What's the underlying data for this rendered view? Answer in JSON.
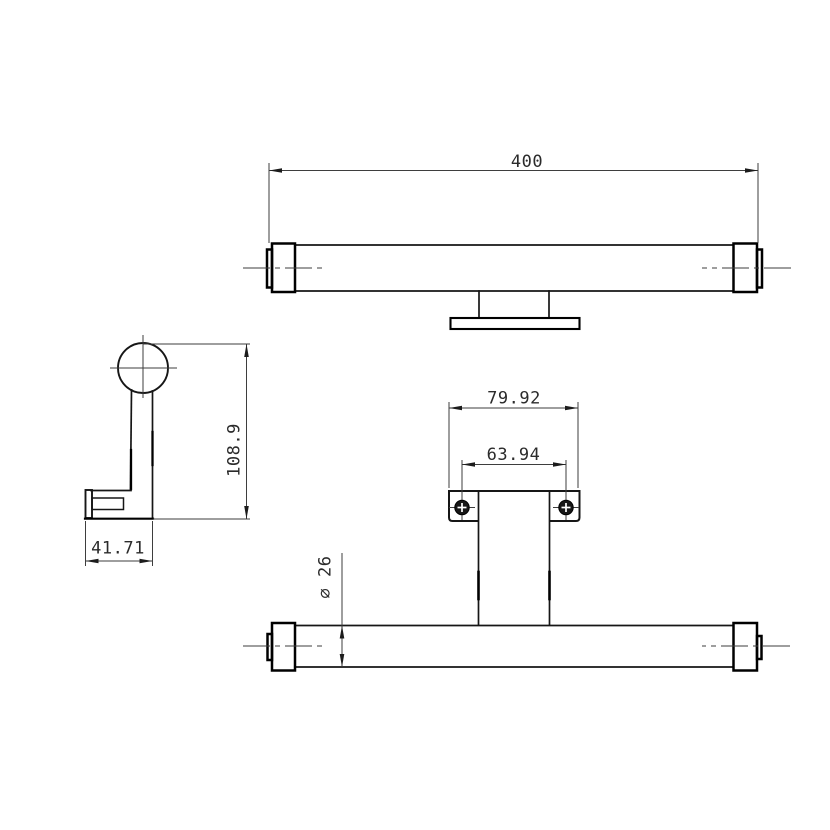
{
  "drawing": {
    "type": "technical-orthographic-views",
    "colors": {
      "background": "#ffffff",
      "object_lines": "#161616",
      "thin_lines": "#3e3e3e",
      "text": "#2b2b2b"
    },
    "top_view": {
      "dimensions": {
        "overall_length": "400"
      }
    },
    "side_view": {
      "dimensions": {
        "overall_height": "108.9",
        "overall_depth": "41.71"
      }
    },
    "front_view": {
      "dimensions": {
        "plate_width": "79.92",
        "screw_spacing": "63.94",
        "tube_diameter": "⌀ 26"
      }
    }
  }
}
